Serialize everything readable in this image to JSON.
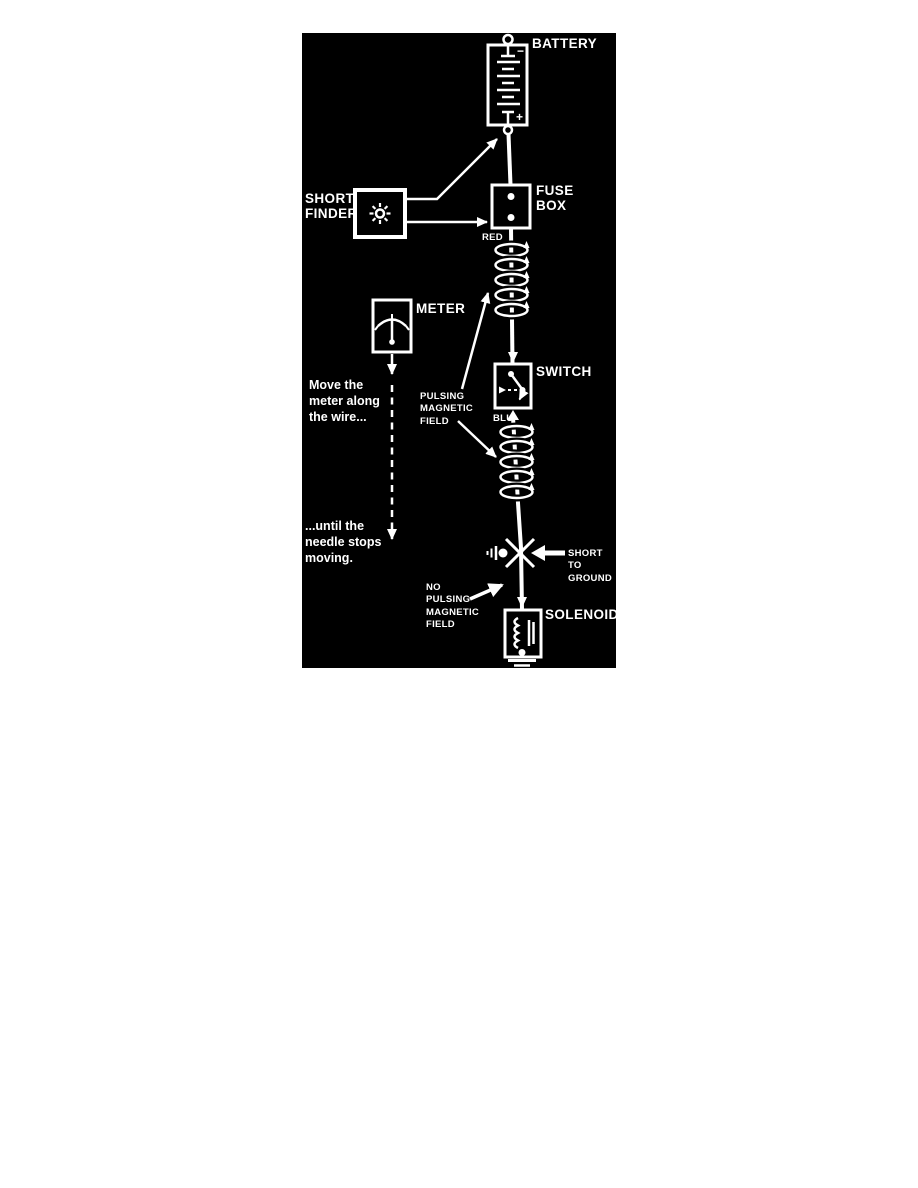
{
  "colors": {
    "page_bg": "#ffffff",
    "panel_bg": "#000000",
    "ink": "#ffffff"
  },
  "components": {
    "battery": {
      "label": "BATTERY",
      "minus_sign": "−",
      "plus_sign": "+"
    },
    "fuse_box": {
      "label": "FUSE\nBOX"
    },
    "short_finder": {
      "label": "SHORT\nFINDER"
    },
    "meter": {
      "label": "METER"
    },
    "switch": {
      "label": "SWITCH"
    },
    "solenoid": {
      "label": "SOLENOID"
    }
  },
  "wires": {
    "red_label": "RED",
    "blue_label": "BLU"
  },
  "annotations": {
    "move_meter": "Move the\nmeter along\nthe wire...",
    "until_needle": "...until the\nneedle stops\nmoving.",
    "pulsing_field": "PULSING\nMAGNETIC\nFIELD",
    "no_pulsing_field": "NO\nPULSING\nMAGNETIC\nFIELD",
    "short_to_ground": "SHORT TO\nGROUND"
  }
}
